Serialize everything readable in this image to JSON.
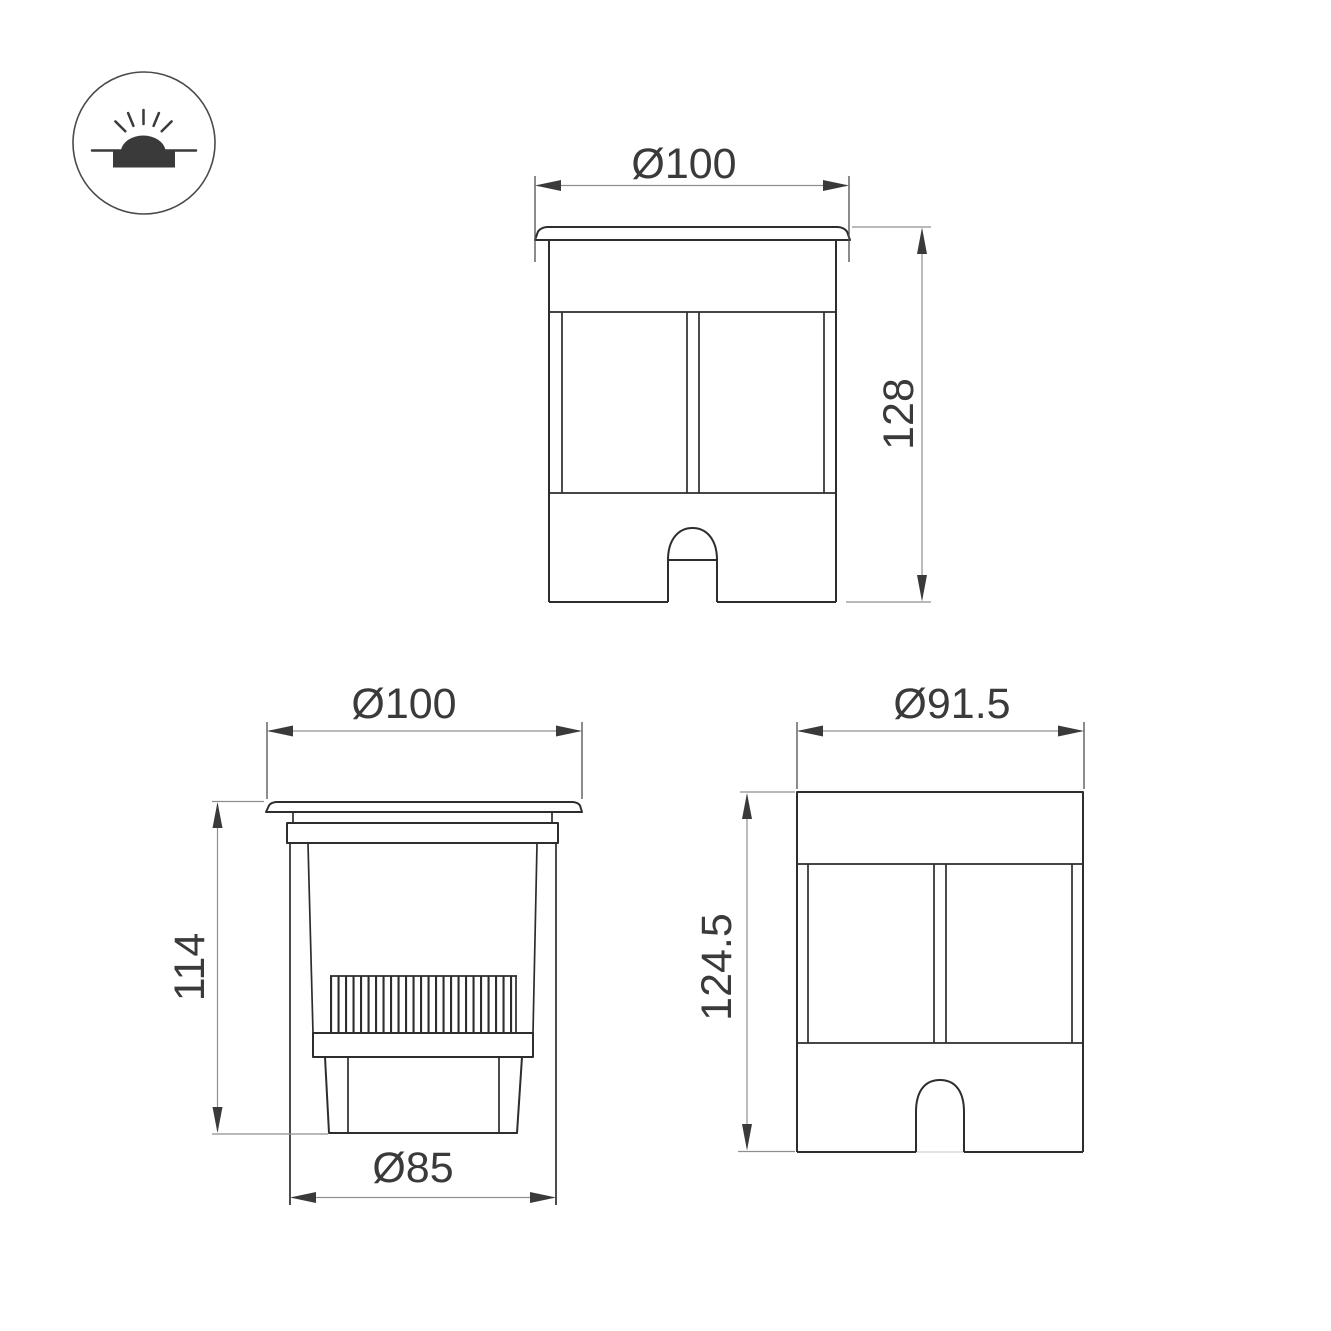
{
  "page": {
    "type": "technical-dimension-drawing",
    "background": "#ffffff"
  },
  "icon": {
    "name": "recessed-ground-luminaire-symbol"
  },
  "labels": {
    "front_width": "Ø100",
    "front_height": "128",
    "section_width": "Ø100",
    "section_height": "114",
    "section_base_width": "Ø85",
    "side_width": "Ø91.5",
    "side_height": "124.5"
  },
  "colors": {
    "outline": "#2d2d2d",
    "dimension_line": "#8f8f8f",
    "extension_line": "#4f4f4f",
    "arrow": "#3a3a3a",
    "text": "#3a3a3a",
    "background": "#ffffff"
  }
}
